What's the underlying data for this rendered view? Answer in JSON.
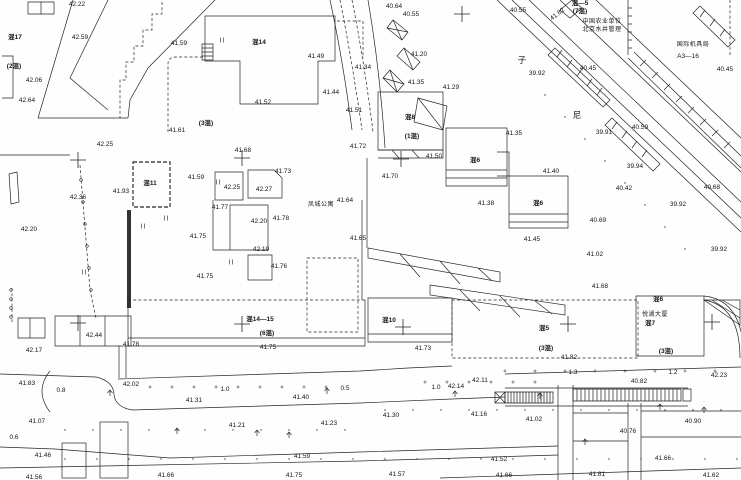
{
  "map": {
    "background": "#fefefe",
    "ink": "#151515",
    "line_color": "#262626",
    "labels": [
      {
        "t": "42.22",
        "x": 77,
        "y": 5
      },
      {
        "t": "42.59",
        "x": 80,
        "y": 38
      },
      {
        "t": "混17",
        "x": 15,
        "y": 38,
        "k": "b"
      },
      {
        "t": "(2混)",
        "x": 14,
        "y": 67,
        "k": "b"
      },
      {
        "t": "42.06",
        "x": 34,
        "y": 81
      },
      {
        "t": "42.64",
        "x": 27,
        "y": 101
      },
      {
        "t": "41.59",
        "x": 179,
        "y": 44
      },
      {
        "t": "(3混)",
        "x": 206,
        "y": 124,
        "k": "b"
      },
      {
        "t": "41.61",
        "x": 177,
        "y": 131
      },
      {
        "t": "42.25",
        "x": 105,
        "y": 145
      },
      {
        "t": "42.36",
        "x": 78,
        "y": 198
      },
      {
        "t": "42.20",
        "x": 29,
        "y": 230
      },
      {
        "t": "41.93",
        "x": 121,
        "y": 192
      },
      {
        "t": "混11",
        "x": 150,
        "y": 184,
        "k": "b"
      },
      {
        "t": "41.59",
        "x": 196,
        "y": 178
      },
      {
        "t": "42.25",
        "x": 232,
        "y": 188
      },
      {
        "t": "42.27",
        "x": 264,
        "y": 190
      },
      {
        "t": "41.77",
        "x": 220,
        "y": 208
      },
      {
        "t": "42.20",
        "x": 259,
        "y": 222
      },
      {
        "t": "41.78",
        "x": 281,
        "y": 219
      },
      {
        "t": "42.19",
        "x": 261,
        "y": 250
      },
      {
        "t": "41.76",
        "x": 279,
        "y": 267
      },
      {
        "t": "41.75",
        "x": 198,
        "y": 237
      },
      {
        "t": "41.75",
        "x": 205,
        "y": 277
      },
      {
        "t": "41.68",
        "x": 243,
        "y": 151
      },
      {
        "t": "41.73",
        "x": 283,
        "y": 172
      },
      {
        "t": "41.52",
        "x": 263,
        "y": 103
      },
      {
        "t": "混14",
        "x": 259,
        "y": 43,
        "k": "b"
      },
      {
        "t": "41.49",
        "x": 316,
        "y": 57
      },
      {
        "t": "41.44",
        "x": 331,
        "y": 93
      },
      {
        "t": "41.51",
        "x": 354,
        "y": 111
      },
      {
        "t": "凤城公寓",
        "x": 321,
        "y": 205,
        "k": "n"
      },
      {
        "t": "41.64",
        "x": 345,
        "y": 201
      },
      {
        "t": "41.65",
        "x": 358,
        "y": 239
      },
      {
        "t": "41.72",
        "x": 358,
        "y": 147
      },
      {
        "t": "41.70",
        "x": 390,
        "y": 177
      },
      {
        "t": "40.64",
        "x": 394,
        "y": 7
      },
      {
        "t": "40.55",
        "x": 411,
        "y": 15
      },
      {
        "t": "41.34",
        "x": 363,
        "y": 68
      },
      {
        "t": "41.20",
        "x": 419,
        "y": 55
      },
      {
        "t": "41.35",
        "x": 416,
        "y": 83
      },
      {
        "t": "41.29",
        "x": 451,
        "y": 88
      },
      {
        "t": "混8",
        "x": 410,
        "y": 118,
        "k": "b"
      },
      {
        "t": "(1混)",
        "x": 412,
        "y": 137,
        "k": "b"
      },
      {
        "t": "41.50",
        "x": 434,
        "y": 157
      },
      {
        "t": "41.35",
        "x": 514,
        "y": 134
      },
      {
        "t": "混6",
        "x": 475,
        "y": 161,
        "k": "b"
      },
      {
        "t": "41.38",
        "x": 486,
        "y": 204
      },
      {
        "t": "混6",
        "x": 538,
        "y": 204,
        "k": "b"
      },
      {
        "t": "41.45",
        "x": 532,
        "y": 240
      },
      {
        "t": "41.40",
        "x": 551,
        "y": 172
      },
      {
        "t": "40.55",
        "x": 518,
        "y": 11
      },
      {
        "t": "41.82",
        "x": 558,
        "y": 15,
        "rot": -38
      },
      {
        "t": "混—5",
        "x": 580,
        "y": 4,
        "k": "b"
      },
      {
        "t": "(7混)",
        "x": 580,
        "y": 12,
        "k": "b"
      },
      {
        "t": "中国农业单位",
        "x": 602,
        "y": 22,
        "k": "n"
      },
      {
        "t": "北京水井管理",
        "x": 602,
        "y": 30,
        "k": "n"
      },
      {
        "t": "国际机具局",
        "x": 693,
        "y": 45,
        "k": "n"
      },
      {
        "t": "A3—16",
        "x": 688,
        "y": 57
      },
      {
        "t": "子",
        "x": 522,
        "y": 60,
        "k": "r"
      },
      {
        "t": "尼",
        "x": 577,
        "y": 115,
        "k": "r"
      },
      {
        "t": "39.92",
        "x": 537,
        "y": 74
      },
      {
        "t": "40.45",
        "x": 588,
        "y": 69
      },
      {
        "t": "40.45",
        "x": 725,
        "y": 70
      },
      {
        "t": "39.91",
        "x": 604,
        "y": 133
      },
      {
        "t": "40.59",
        "x": 640,
        "y": 128
      },
      {
        "t": "39.94",
        "x": 635,
        "y": 167
      },
      {
        "t": "40.42",
        "x": 624,
        "y": 189
      },
      {
        "t": "40.68",
        "x": 712,
        "y": 188
      },
      {
        "t": "39.92",
        "x": 678,
        "y": 205
      },
      {
        "t": "40.69",
        "x": 598,
        "y": 221
      },
      {
        "t": "39.92",
        "x": 719,
        "y": 250
      },
      {
        "t": "41.02",
        "x": 595,
        "y": 255
      },
      {
        "t": "41.68",
        "x": 600,
        "y": 287
      },
      {
        "t": "42.44",
        "x": 94,
        "y": 336
      },
      {
        "t": "42.17",
        "x": 34,
        "y": 351
      },
      {
        "t": "41.78",
        "x": 131,
        "y": 345
      },
      {
        "t": "41.83",
        "x": 27,
        "y": 384
      },
      {
        "t": "42.02",
        "x": 131,
        "y": 385
      },
      {
        "t": "0.8",
        "x": 61,
        "y": 391,
        "k": "w"
      },
      {
        "t": "1.0",
        "x": 225,
        "y": 390,
        "k": "w"
      },
      {
        "t": "41.31",
        "x": 194,
        "y": 401
      },
      {
        "t": "41.07",
        "x": 37,
        "y": 422
      },
      {
        "t": "41.21",
        "x": 237,
        "y": 426
      },
      {
        "t": "0.6",
        "x": 14,
        "y": 438,
        "k": "w"
      },
      {
        "t": "41.46",
        "x": 43,
        "y": 456
      },
      {
        "t": "41.56",
        "x": 34,
        "y": 478
      },
      {
        "t": "41.66",
        "x": 166,
        "y": 476
      },
      {
        "t": "41.59",
        "x": 302,
        "y": 457
      },
      {
        "t": "41.75",
        "x": 294,
        "y": 476
      },
      {
        "t": "41.23",
        "x": 329,
        "y": 424
      },
      {
        "t": "41.40",
        "x": 301,
        "y": 398
      },
      {
        "t": "0.5",
        "x": 345,
        "y": 389,
        "k": "w"
      },
      {
        "t": "混14—15",
        "x": 260,
        "y": 320,
        "k": "b"
      },
      {
        "t": "(6混)",
        "x": 267,
        "y": 334,
        "k": "b"
      },
      {
        "t": "41.75",
        "x": 268,
        "y": 348
      },
      {
        "t": "混10",
        "x": 389,
        "y": 321,
        "k": "b"
      },
      {
        "t": "41.73",
        "x": 423,
        "y": 349
      },
      {
        "t": "41.30",
        "x": 391,
        "y": 416
      },
      {
        "t": "1.0",
        "x": 436,
        "y": 388,
        "k": "w"
      },
      {
        "t": "42.14",
        "x": 456,
        "y": 387
      },
      {
        "t": "42.11",
        "x": 480,
        "y": 381
      },
      {
        "t": "41.16",
        "x": 479,
        "y": 415
      },
      {
        "t": "41.02",
        "x": 534,
        "y": 420
      },
      {
        "t": "41.52",
        "x": 499,
        "y": 460
      },
      {
        "t": "41.57",
        "x": 397,
        "y": 475
      },
      {
        "t": "41.66",
        "x": 504,
        "y": 476
      },
      {
        "t": "混5",
        "x": 544,
        "y": 329,
        "k": "b"
      },
      {
        "t": "(3混)",
        "x": 546,
        "y": 349,
        "k": "b"
      },
      {
        "t": "41.82",
        "x": 569,
        "y": 358
      },
      {
        "t": "(3混)",
        "x": 666,
        "y": 352,
        "k": "b"
      },
      {
        "t": "悦湖大厦",
        "x": 655,
        "y": 315,
        "k": "n"
      },
      {
        "t": "混7",
        "x": 650,
        "y": 324,
        "k": "b"
      },
      {
        "t": "混6",
        "x": 658,
        "y": 300,
        "k": "b"
      },
      {
        "t": "1.3",
        "x": 573,
        "y": 373,
        "k": "w"
      },
      {
        "t": "1.2",
        "x": 673,
        "y": 373,
        "k": "w"
      },
      {
        "t": "42.23",
        "x": 719,
        "y": 376
      },
      {
        "t": "40.82",
        "x": 639,
        "y": 382
      },
      {
        "t": "40.76",
        "x": 628,
        "y": 432
      },
      {
        "t": "40.90",
        "x": 693,
        "y": 422
      },
      {
        "t": "41.66",
        "x": 663,
        "y": 459
      },
      {
        "t": "41.81",
        "x": 597,
        "y": 475
      },
      {
        "t": "41.62",
        "x": 711,
        "y": 476
      }
    ],
    "crosses": [
      [
        78,
        160
      ],
      [
        242,
        158
      ],
      [
        401,
        159
      ],
      [
        462,
        14
      ],
      [
        78,
        323
      ],
      [
        242,
        324
      ],
      [
        403,
        327
      ],
      [
        568,
        324
      ],
      [
        712,
        322
      ]
    ],
    "trees": [
      [
        110,
        393
      ],
      [
        327,
        391
      ],
      [
        455,
        394
      ],
      [
        540,
        396
      ],
      [
        177,
        431
      ],
      [
        257,
        433
      ],
      [
        289,
        435
      ],
      [
        660,
        407
      ],
      [
        704,
        410
      ],
      [
        585,
        442
      ]
    ],
    "plus_marks": [
      [
        150,
        387
      ],
      [
        172,
        387
      ],
      [
        194,
        387
      ],
      [
        216,
        387
      ],
      [
        238,
        387
      ],
      [
        260,
        387
      ],
      [
        282,
        387
      ],
      [
        304,
        387
      ],
      [
        326,
        387
      ],
      [
        425,
        382
      ],
      [
        447,
        382
      ],
      [
        469,
        382
      ],
      [
        491,
        382
      ],
      [
        513,
        382
      ],
      [
        535,
        382
      ],
      [
        505,
        371
      ],
      [
        535,
        371
      ],
      [
        565,
        371
      ],
      [
        595,
        371
      ],
      [
        625,
        371
      ],
      [
        655,
        371
      ],
      [
        685,
        371
      ],
      [
        715,
        371
      ]
    ],
    "dot_marks": [
      [
        385,
        410
      ],
      [
        413,
        410
      ],
      [
        441,
        410
      ],
      [
        469,
        410
      ],
      [
        497,
        410
      ],
      [
        525,
        410
      ],
      [
        553,
        410
      ],
      [
        581,
        410
      ],
      [
        609,
        410
      ],
      [
        637,
        410
      ],
      [
        665,
        410
      ],
      [
        693,
        410
      ],
      [
        721,
        410
      ],
      [
        65,
        430
      ],
      [
        93,
        430
      ],
      [
        121,
        430
      ],
      [
        149,
        430
      ],
      [
        177,
        430
      ],
      [
        205,
        430
      ],
      [
        233,
        430
      ],
      [
        261,
        430
      ],
      [
        289,
        430
      ],
      [
        317,
        430
      ],
      [
        345,
        430
      ],
      [
        65,
        459
      ],
      [
        97,
        459
      ],
      [
        129,
        459
      ],
      [
        161,
        459
      ],
      [
        193,
        459
      ],
      [
        225,
        459
      ],
      [
        257,
        459
      ],
      [
        289,
        459
      ],
      [
        321,
        459
      ],
      [
        353,
        459
      ],
      [
        385,
        459
      ],
      [
        417,
        459
      ],
      [
        449,
        459
      ],
      [
        481,
        459
      ],
      [
        513,
        459
      ],
      [
        545,
        459
      ],
      [
        577,
        459
      ],
      [
        609,
        459
      ],
      [
        641,
        459
      ],
      [
        673,
        459
      ],
      [
        705,
        459
      ],
      [
        737,
        459
      ],
      [
        545,
        95
      ],
      [
        565,
        117
      ],
      [
        585,
        139
      ],
      [
        605,
        161
      ],
      [
        625,
        183
      ],
      [
        645,
        205
      ],
      [
        665,
        227
      ],
      [
        685,
        249
      ]
    ],
    "fence_circles": [
      [
        11,
        290
      ],
      [
        11,
        299
      ],
      [
        11,
        308
      ],
      [
        11,
        317
      ],
      [
        81,
        180
      ],
      [
        83,
        202
      ],
      [
        85,
        224
      ],
      [
        87,
        246
      ],
      [
        89,
        268
      ],
      [
        91,
        290
      ]
    ],
    "tick_pairs": [
      [
        218,
        182
      ],
      [
        166,
        218
      ],
      [
        231,
        262
      ],
      [
        143,
        226
      ],
      [
        84,
        272
      ],
      [
        222,
        40
      ]
    ],
    "hatch_strips": [
      {
        "x": 505,
        "y": 392,
        "w": 48,
        "h": 11,
        "s": 3
      },
      {
        "x": 573,
        "y": 389,
        "w": 108,
        "h": 12,
        "s": 4
      }
    ]
  }
}
